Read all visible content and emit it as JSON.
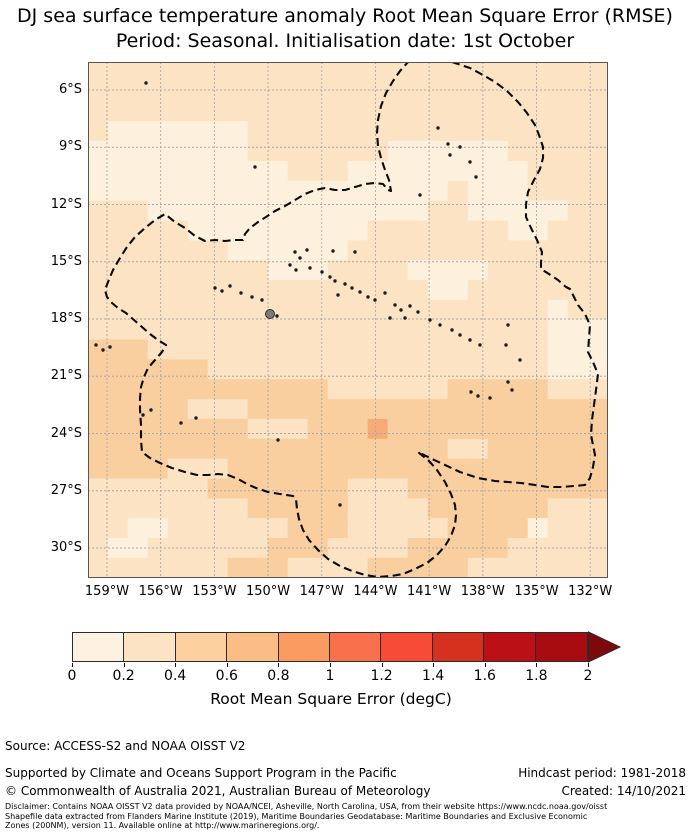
{
  "title": {
    "line1": "DJ sea surface temperature anomaly Root Mean Square Error (RMSE)",
    "line2": "Period: Seasonal. Initialisation date: 1st October"
  },
  "map": {
    "y_tick_labels": [
      "6°S",
      "9°S",
      "12°S",
      "15°S",
      "18°S",
      "21°S",
      "24°S",
      "27°S",
      "30°S"
    ],
    "x_tick_labels": [
      "159°W",
      "156°W",
      "153°W",
      "150°W",
      "147°W",
      "144°W",
      "141°W",
      "138°W",
      "135°W",
      "132°W"
    ]
  },
  "colorbar": {
    "tick_labels": [
      "0",
      "0.2",
      "0.4",
      "0.6",
      "0.8",
      "1",
      "1.2",
      "1.4",
      "1.6",
      "1.8",
      "2"
    ],
    "segment_colors": [
      "#fdf2e2",
      "#fbe3c3",
      "#fbd09e",
      "#fbbc85",
      "#fb9b62",
      "#f9704c",
      "#f74b38",
      "#d6301f",
      "#bb1016",
      "#a80c10"
    ],
    "arrow_color": "#7e090d",
    "outline_color": "#2b2b2b",
    "label": "Root Mean Square Error (degC)"
  },
  "footer": {
    "source": "Source: ACCESS-S2 and NOAA OISST V2",
    "supported": "Supported by Climate and Oceans Support Program in the Pacific",
    "hindcast": "Hindcast period: 1981-2018",
    "copyright": "© Commonwealth of Australia 2021, Australian Bureau of Meteorology",
    "created": "Created: 14/10/2021",
    "disclaimer": [
      "Disclaimer: Contains NOAA OISST V2 data provided by NOAA/NCEI, Asheville, North Carolina, USA, from their website https://www.ncdc.noaa.gov/oisst",
      "Shapefile data extracted from Flanders Marine Institute (2019), Maritime Boundaries Geodatabase: Maritime Boundaries and Exclusive Economic",
      "Zones (200NM), version 11. Available online at http://www.marineregions.org/."
    ]
  },
  "chart_data": {
    "type": "heatmap",
    "title": "Sea surface temperature anomaly Root Mean Square Error (RMSE), Period: Seasonal, Initialisation date: 1st October",
    "value_label": "Root Mean Square Error (degC)",
    "value_bins": [
      0,
      0.2,
      0.4,
      0.6,
      0.8,
      1,
      1.2,
      1.4,
      1.6,
      1.8,
      2
    ],
    "lat_ticks_deg_s": [
      6,
      9,
      12,
      15,
      18,
      21,
      24,
      27,
      30
    ],
    "lon_ticks_deg_w": [
      159,
      156,
      153,
      150,
      147,
      144,
      141,
      138,
      135,
      132
    ],
    "lat_range_deg_s": [
      4.5,
      31.6
    ],
    "lon_range_deg_w": [
      160.1,
      131.0
    ],
    "grid_color": "#a8a8a8",
    "level_colors": {
      "0": "#fdf1de",
      "1": "#fbe3c3",
      "2": "#f9cf9f",
      "3": "#f8ab76"
    },
    "level_values_degc": {
      "0": "0-0.2",
      "1": "0.2-0.4",
      "2": "0.4-0.6",
      "3": "0.6-0.8"
    },
    "rows": [
      "11111111111111111111111111",
      "11111111111111111111111111",
      "11111111111111111111111111",
      "10000000111111111111111111",
      "00000000111111100000011111",
      "00000000001110000000001111",
      "00000000000000000010001111",
      "11100000000000000110000011",
      "11111000000000111111100111",
      "11111110000001111111111111",
      "11111111100011110000111111",
      "11111111111111111001111111",
      "11111111111111111111111011",
      "11111111111111111111111000",
      "22211111111111111111111000",
      "22222211111111111111111000",
      "22222222222211111122222111",
      "22222111222222222222222222",
      "22222222111222322222222222",
      "22222222222222222211222222",
      "22221112222222222222222222",
      "11111122222221112222222222",
      "11111111222221111222222111",
      "11001111112221111122220111",
      "10011111122211112222211111",
      "11111112221111222221111111"
    ],
    "islands_px": [
      [
        350,
        66
      ],
      [
        360,
        82
      ],
      [
        372,
        85
      ],
      [
        362,
        93
      ],
      [
        382,
        100
      ],
      [
        388,
        115
      ],
      [
        58,
        21
      ],
      [
        127,
        226
      ],
      [
        134,
        229
      ],
      [
        142,
        224
      ],
      [
        153,
        231
      ],
      [
        164,
        235
      ],
      [
        174,
        238
      ],
      [
        189,
        254
      ],
      [
        207,
        190
      ],
      [
        219,
        188
      ],
      [
        245,
        189
      ],
      [
        267,
        190
      ],
      [
        212,
        196
      ],
      [
        202,
        203
      ],
      [
        208,
        208
      ],
      [
        222,
        206
      ],
      [
        234,
        210
      ],
      [
        242,
        215
      ],
      [
        247,
        219
      ],
      [
        257,
        222
      ],
      [
        264,
        226
      ],
      [
        250,
        233
      ],
      [
        272,
        230
      ],
      [
        280,
        235
      ],
      [
        287,
        238
      ],
      [
        297,
        231
      ],
      [
        307,
        243
      ],
      [
        313,
        248
      ],
      [
        322,
        244
      ],
      [
        330,
        250
      ],
      [
        317,
        256
      ],
      [
        302,
        256
      ],
      [
        342,
        258
      ],
      [
        352,
        263
      ],
      [
        364,
        268
      ],
      [
        372,
        273
      ],
      [
        382,
        278
      ],
      [
        392,
        283
      ],
      [
        420,
        263
      ],
      [
        432,
        298
      ],
      [
        420,
        320
      ],
      [
        424,
        328
      ],
      [
        383,
        330
      ],
      [
        390,
        334
      ],
      [
        402,
        336
      ],
      [
        418,
        283
      ],
      [
        55,
        353
      ],
      [
        63,
        348
      ],
      [
        93,
        361
      ],
      [
        108,
        356
      ],
      [
        8,
        283
      ],
      [
        15,
        288
      ],
      [
        22,
        285
      ],
      [
        190,
        378
      ],
      [
        252,
        443
      ],
      [
        167,
        105
      ],
      [
        332,
        133
      ]
    ],
    "main_island_px": [
      182,
      252
    ],
    "eez_boundary_px": [
      [
        364,
        0
      ],
      [
        382,
        6
      ],
      [
        395,
        13
      ],
      [
        407,
        20
      ],
      [
        419,
        29
      ],
      [
        430,
        40
      ],
      [
        439,
        51
      ],
      [
        447,
        63
      ],
      [
        451,
        73
      ],
      [
        455,
        85
      ],
      [
        455,
        96
      ],
      [
        452,
        107
      ],
      [
        446,
        118
      ],
      [
        440,
        130
      ],
      [
        438,
        142
      ],
      [
        438,
        155
      ],
      [
        443,
        166
      ],
      [
        449,
        178
      ],
      [
        454,
        190
      ],
      [
        453,
        200
      ],
      [
        453,
        207
      ],
      [
        461,
        212
      ],
      [
        470,
        218
      ],
      [
        478,
        225
      ],
      [
        482,
        227
      ],
      [
        486,
        235
      ],
      [
        490,
        243
      ],
      [
        497,
        252
      ],
      [
        502,
        263
      ],
      [
        501,
        276
      ],
      [
        500,
        290
      ],
      [
        505,
        300
      ],
      [
        510,
        312
      ],
      [
        508,
        328
      ],
      [
        506,
        343
      ],
      [
        504,
        358
      ],
      [
        503,
        373
      ],
      [
        505,
        383
      ],
      [
        507,
        393
      ],
      [
        505,
        405
      ],
      [
        502,
        416
      ],
      [
        497,
        423
      ],
      [
        486,
        424
      ],
      [
        473,
        425
      ],
      [
        460,
        425
      ],
      [
        447,
        423
      ],
      [
        433,
        421
      ],
      [
        420,
        420
      ],
      [
        407,
        419
      ],
      [
        390,
        416
      ],
      [
        372,
        410
      ],
      [
        357,
        403
      ],
      [
        342,
        396
      ],
      [
        330,
        390
      ],
      [
        341,
        399
      ],
      [
        349,
        408
      ],
      [
        357,
        420
      ],
      [
        363,
        432
      ],
      [
        367,
        443
      ],
      [
        368,
        453
      ],
      [
        367,
        463
      ],
      [
        363,
        474
      ],
      [
        357,
        484
      ],
      [
        349,
        493
      ],
      [
        339,
        501
      ],
      [
        327,
        507
      ],
      [
        315,
        512
      ],
      [
        303,
        514
      ],
      [
        290,
        515
      ],
      [
        277,
        513
      ],
      [
        264,
        509
      ],
      [
        252,
        504
      ],
      [
        240,
        497
      ],
      [
        230,
        488
      ],
      [
        221,
        478
      ],
      [
        215,
        468
      ],
      [
        211,
        457
      ],
      [
        209,
        447
      ],
      [
        208,
        437
      ],
      [
        205,
        434
      ],
      [
        192,
        432
      ],
      [
        180,
        430
      ],
      [
        168,
        426
      ],
      [
        159,
        422
      ],
      [
        150,
        417
      ],
      [
        140,
        413
      ],
      [
        130,
        412
      ],
      [
        120,
        413
      ],
      [
        109,
        413
      ],
      [
        97,
        410
      ],
      [
        84,
        406
      ],
      [
        72,
        401
      ],
      [
        62,
        396
      ],
      [
        54,
        390
      ],
      [
        53,
        378
      ],
      [
        53,
        363
      ],
      [
        52,
        348
      ],
      [
        52,
        336
      ],
      [
        53,
        325
      ],
      [
        56,
        315
      ],
      [
        60,
        306
      ],
      [
        67,
        298
      ],
      [
        74,
        290
      ],
      [
        78,
        283
      ],
      [
        70,
        278
      ],
      [
        62,
        272
      ],
      [
        54,
        265
      ],
      [
        46,
        258
      ],
      [
        38,
        251
      ],
      [
        30,
        246
      ],
      [
        24,
        241
      ],
      [
        19,
        235
      ],
      [
        17,
        228
      ],
      [
        20,
        220
      ],
      [
        25,
        208
      ],
      [
        32,
        196
      ],
      [
        39,
        185
      ],
      [
        47,
        175
      ],
      [
        57,
        166
      ],
      [
        67,
        158
      ],
      [
        77,
        152
      ],
      [
        87,
        160
      ],
      [
        97,
        166
      ],
      [
        107,
        174
      ],
      [
        117,
        179
      ],
      [
        127,
        178
      ],
      [
        137,
        179
      ],
      [
        147,
        178
      ],
      [
        155,
        178
      ],
      [
        157,
        172
      ],
      [
        162,
        166
      ],
      [
        170,
        160
      ],
      [
        178,
        155
      ],
      [
        187,
        149
      ],
      [
        197,
        144
      ],
      [
        207,
        138
      ],
      [
        217,
        132
      ],
      [
        227,
        128
      ],
      [
        237,
        126
      ],
      [
        247,
        128
      ],
      [
        257,
        128
      ],
      [
        267,
        125
      ],
      [
        277,
        122
      ],
      [
        287,
        121
      ],
      [
        295,
        122
      ],
      [
        300,
        128
      ],
      [
        303,
        129
      ],
      [
        301,
        118
      ],
      [
        297,
        108
      ],
      [
        293,
        96
      ],
      [
        290,
        84
      ],
      [
        289,
        71
      ],
      [
        290,
        58
      ],
      [
        293,
        44
      ],
      [
        298,
        31
      ],
      [
        305,
        19
      ],
      [
        312,
        9
      ],
      [
        320,
        0
      ]
    ]
  }
}
